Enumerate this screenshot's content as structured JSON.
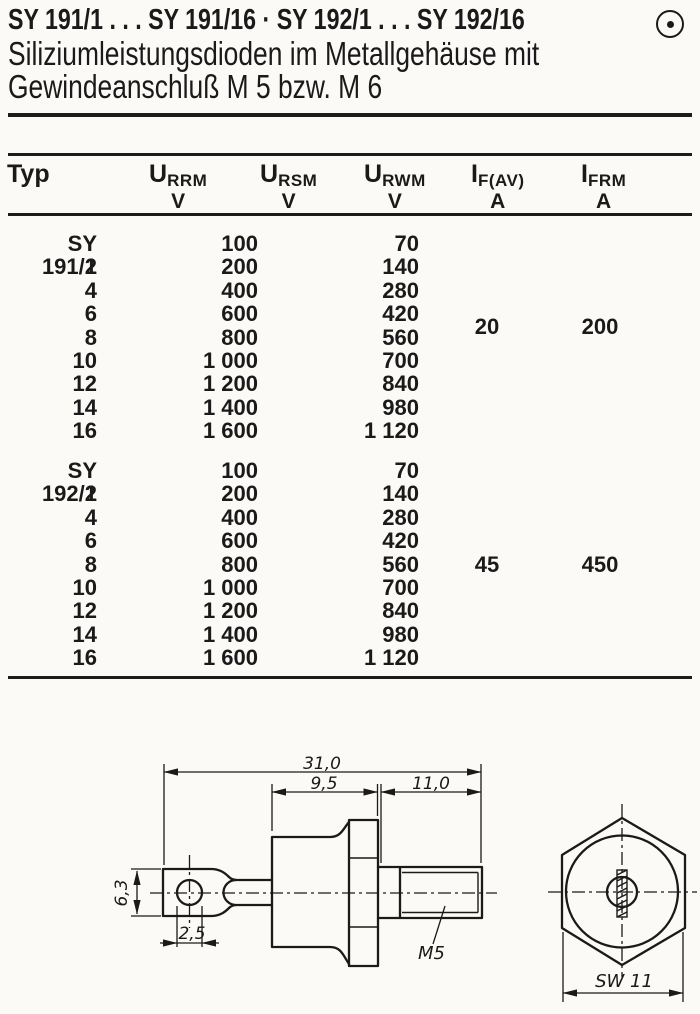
{
  "header": {
    "title": "SY 191/1 . . . SY 191/16 · SY 192/1 . . . SY 192/16",
    "subtitle_line1": "Siliziumleistungsdioden im Metallgehäuse mit",
    "subtitle_line2": "Gewindeanschluß M 5 bzw. M 6",
    "corner_icon": "circled-dot"
  },
  "table": {
    "columns": [
      {
        "sym": "Typ",
        "sub": "",
        "unit": ""
      },
      {
        "sym": "U",
        "sub": "RRM",
        "unit": "V"
      },
      {
        "sym": "U",
        "sub": "RSM",
        "unit": "V"
      },
      {
        "sym": "U",
        "sub": "RWM",
        "unit": "V"
      },
      {
        "sym": "I",
        "sub": "F(AV)",
        "unit": "A"
      },
      {
        "sym": "I",
        "sub": "FRM",
        "unit": "A"
      }
    ],
    "groups": [
      {
        "name": "SY 191",
        "rows": [
          {
            "typ": "SY 191/1",
            "urrm_ursm": "100",
            "urwm": "70"
          },
          {
            "typ": "2",
            "urrm_ursm": "200",
            "urwm": "140"
          },
          {
            "typ": "4",
            "urrm_ursm": "400",
            "urwm": "280"
          },
          {
            "typ": "6",
            "urrm_ursm": "600",
            "urwm": "420"
          },
          {
            "typ": "8",
            "urrm_ursm": "800",
            "urwm": "560"
          },
          {
            "typ": "10",
            "urrm_ursm": "1 000",
            "urwm": "700"
          },
          {
            "typ": "12",
            "urrm_ursm": "1 200",
            "urwm": "840"
          },
          {
            "typ": "14",
            "urrm_ursm": "1 400",
            "urwm": "980"
          },
          {
            "typ": "16",
            "urrm_ursm": "1 600",
            "urwm": "1 120"
          }
        ],
        "if_av": "20",
        "ifrm": "200"
      },
      {
        "name": "SY 192",
        "rows": [
          {
            "typ": "SY 192/1",
            "urrm_ursm": "100",
            "urwm": "70"
          },
          {
            "typ": "2",
            "urrm_ursm": "200",
            "urwm": "140"
          },
          {
            "typ": "4",
            "urrm_ursm": "400",
            "urwm": "280"
          },
          {
            "typ": "6",
            "urrm_ursm": "600",
            "urwm": "420"
          },
          {
            "typ": "8",
            "urrm_ursm": "800",
            "urwm": "560"
          },
          {
            "typ": "10",
            "urrm_ursm": "1 000",
            "urwm": "700"
          },
          {
            "typ": "12",
            "urrm_ursm": "1 200",
            "urwm": "840"
          },
          {
            "typ": "14",
            "urrm_ursm": "1 400",
            "urwm": "980"
          },
          {
            "typ": "16",
            "urrm_ursm": "1 600",
            "urwm": "1 120"
          }
        ],
        "if_av": "45",
        "ifrm": "450"
      }
    ]
  },
  "drawing": {
    "side_view": {
      "dim_overall_length": "31,0",
      "dim_body_length": "9,5",
      "dim_stud_length": "11,0",
      "dim_lug_width": "6,3",
      "dim_hole_diameter": "2,5",
      "thread_label": "M5"
    },
    "end_view": {
      "dim_across_flats": "SW 11"
    }
  }
}
